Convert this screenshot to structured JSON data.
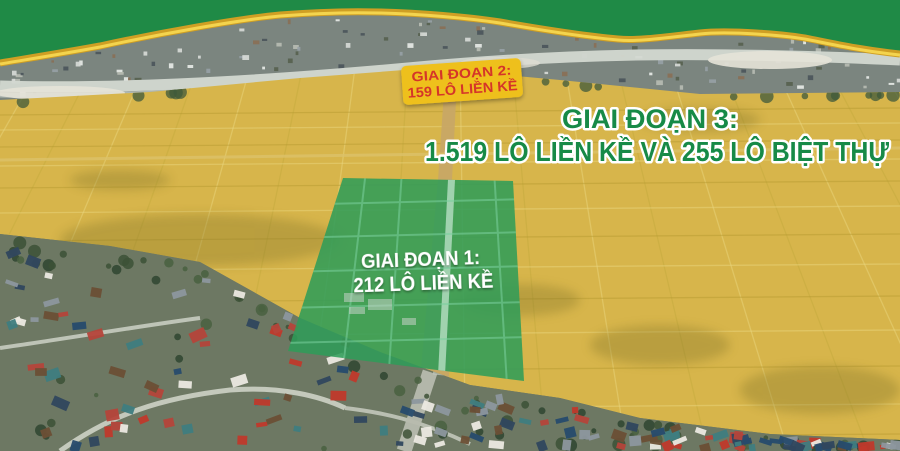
{
  "labels": {
    "phase2_badge": {
      "line1": "GIAI ĐOẠN 2:",
      "line2": "159 LÔ LIỀN KỀ"
    },
    "phase3_title": {
      "line1": "GIAI ĐOẠN 3:",
      "line2": "1.519 LÔ LIỀN KỀ VÀ 255 LÔ BIỆT THỰ"
    },
    "phase1_area": {
      "line1": "GIAI ĐOẠN 1:",
      "line2": "212 LÔ LIỀN KỀ"
    }
  },
  "colors": {
    "accent_green": "#1f8a46",
    "title_green": "#178a47",
    "badge_yellow": "#eec01f",
    "badge_text_red": "#d53529",
    "trim_gold": "#cf9f24",
    "trim_gold_light": "#f4d44e",
    "field_gold": "#d7b54b",
    "phase1_overlay_green": "#2f9c58",
    "label_white": "#ffffff"
  }
}
